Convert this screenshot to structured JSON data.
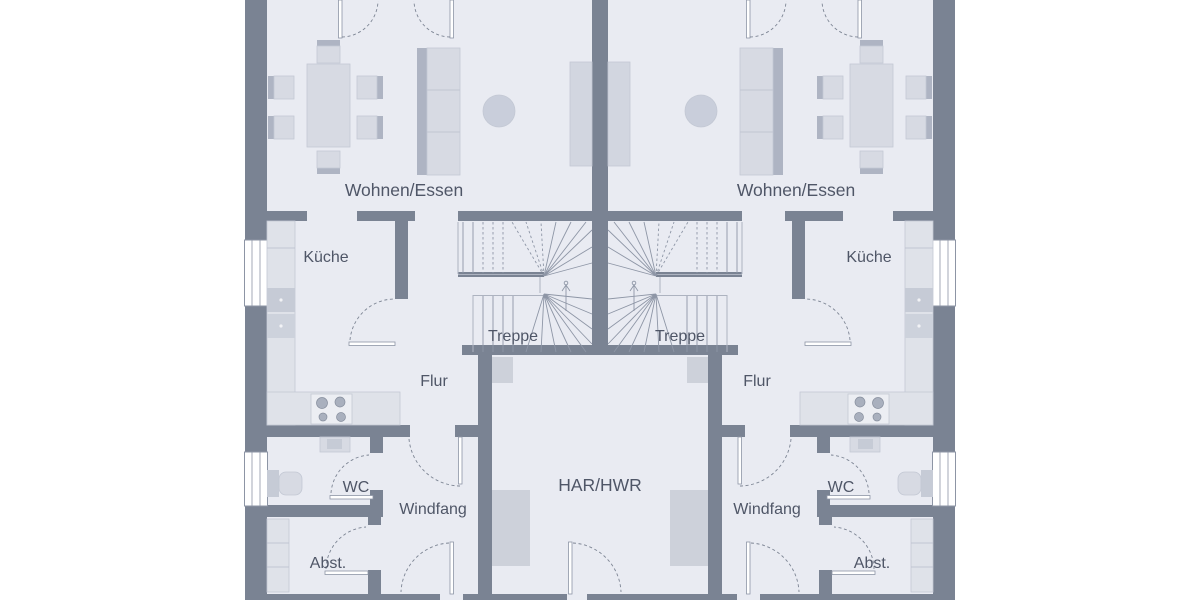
{
  "plan_type": "residential duplex ground-floor plan, two mirrored units",
  "rooms": {
    "wohnen_essen": "Wohnen/Essen",
    "kueche": "Küche",
    "treppe": "Treppe",
    "flur": "Flur",
    "wc": "WC",
    "windfang": "Windfang",
    "abst": "Abst.",
    "har_hwr": "HAR/HWR"
  },
  "colors": {
    "background": "#ffffff",
    "wall": "#7a8393",
    "floor": "#e9ebf2",
    "furniture": "#d7dae3",
    "furniture-dark": "#aeb4c3",
    "counter": "#dfe2e9",
    "line": "#8e96a6",
    "label": "#4f5667",
    "window-frame": "#8d95a5"
  }
}
